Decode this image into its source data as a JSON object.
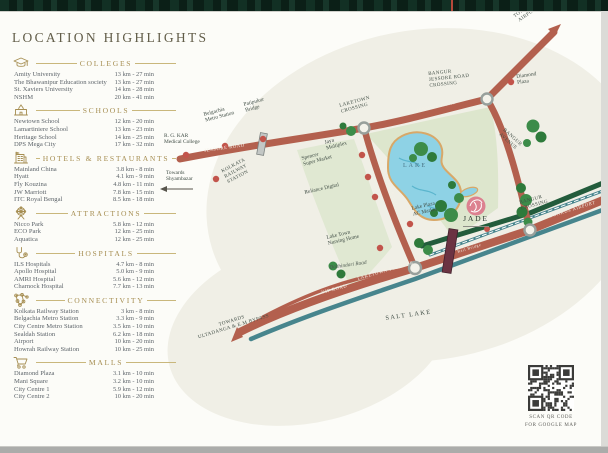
{
  "title": "LOCATION HIGHLIGHTS",
  "sidebar": {
    "sections": [
      {
        "id": "colleges",
        "label": "COLLEGES",
        "icon": "graduation-cap-icon",
        "items": [
          {
            "name": "Amity University",
            "value": "13 km - 27 min"
          },
          {
            "name": "The Bhawanipur Education society",
            "value": "13 km - 27 min"
          },
          {
            "name": "St. Xaviers University",
            "value": "14 km - 28 min"
          },
          {
            "name": "NSHM",
            "value": "20 km - 41 min"
          }
        ]
      },
      {
        "id": "schools",
        "label": "SCHOOLS",
        "icon": "school-icon",
        "items": [
          {
            "name": "Newtown School",
            "value": "12 km - 20 min"
          },
          {
            "name": "Lamartiniere School",
            "value": "13 km - 23 min"
          },
          {
            "name": "Heritage School",
            "value": "14 km - 25 min"
          },
          {
            "name": "DPS Mega City",
            "value": "17 km - 32 min"
          }
        ]
      },
      {
        "id": "hotels",
        "label": "HOTELS & RESTAURANTS",
        "icon": "hotel-icon",
        "items": [
          {
            "name": "Mainland China",
            "value": "3.8 km - 8 min"
          },
          {
            "name": "Hyatt",
            "value": "4.1 km - 9 min"
          },
          {
            "name": "Fly Kouzina",
            "value": "4.8 km - 11 min"
          },
          {
            "name": "JW Marriott",
            "value": "7.8 km - 15 min"
          },
          {
            "name": "ITC Royal Bengal",
            "value": "8.5 km - 18 min"
          }
        ]
      },
      {
        "id": "attractions",
        "label": "ATTRACTIONS",
        "icon": "ferris-wheel-icon",
        "items": [
          {
            "name": "Nicco Park",
            "value": "5.8 km - 12 min"
          },
          {
            "name": "ECO Park",
            "value": "12 km - 25 min"
          },
          {
            "name": "Aquatica",
            "value": "12 km - 25 min"
          }
        ]
      },
      {
        "id": "hospitals",
        "label": "HOSPITALS",
        "icon": "stethoscope-icon",
        "items": [
          {
            "name": "ILS Hospitals",
            "value": "4.7 km - 8 min"
          },
          {
            "name": "Apollo Hospital",
            "value": "5.0 km - 9 min"
          },
          {
            "name": "AMRI Hospital",
            "value": "5.6 km - 12 min"
          },
          {
            "name": "Charnock Hospital",
            "value": "7.7 km - 13 min"
          }
        ]
      },
      {
        "id": "connectivity",
        "label": "CONNECTIVITY",
        "icon": "network-icon",
        "items": [
          {
            "name": "Kolkata Railway Station",
            "value": "3 km - 8 min"
          },
          {
            "name": "Belgachia Metro Station",
            "value": "3.3 km - 9 min"
          },
          {
            "name": "City Centre Metro Station",
            "value": "3.5 km - 10 min"
          },
          {
            "name": "Sealdah Station",
            "value": "6.2 km - 18 min"
          },
          {
            "name": "Airport",
            "value": "10 km - 20 min"
          },
          {
            "name": "Howrah Railway Station",
            "value": "10 km - 25 min"
          }
        ]
      },
      {
        "id": "malls",
        "label": "MALLS",
        "icon": "cart-icon",
        "items": [
          {
            "name": "Diamond Plaza",
            "value": "3.1 km - 10 min"
          },
          {
            "name": "Mani Square",
            "value": "3.2 km - 10 min"
          },
          {
            "name": "City Centre 1",
            "value": "5.9 km - 12 min"
          },
          {
            "name": "City Centre 2",
            "value": "10 km - 20 min"
          }
        ]
      }
    ]
  },
  "map": {
    "labels": {
      "rgkar": "R. G. KAR\nMedical College",
      "towards_shyambazar": "Towards\nShyambazar",
      "belgachia": "Belgachia\nMetro Station",
      "patipukur": "Patipukur\nBridge",
      "kolkata_station": "KOLKATA\nRAILWAY\nSTATION",
      "laketown_crossing": "LAKETOWN\nCROSSING",
      "bangur_jessore_crossing": "BANGUR\nJESSORE ROAD\nCROSSING",
      "towards_airport_top": "TOWARDS\nAIRPORT",
      "diamond_plaza": "Diamond\nPlaza",
      "bangur_avenue": "BANGUR\nAVENUE",
      "jaya": "Jaya\nMultiplex",
      "spencer": "Spencer\nSuper Market",
      "reliance": "Reliance Digital",
      "nursing_home": "Lake Town\nNursing Home",
      "lake_plaza": "Lake Plaza\nAC Market",
      "bangur_crossing": "BANGUR\nCROSSING",
      "salt_lake": "SALT LAKE",
      "towards_bypass": "TOWARDS\nULTADANGA & E.M BYPASS",
      "dakhindari": "Dakhindari Road",
      "lake": "LAKE",
      "jade": "JADE"
    },
    "roads": {
      "jessore": "JESSORE ROAD",
      "vip": "VIP ROAD",
      "laketown_flyover": "LAKETOWN FLYOVER",
      "laketown_road": "LAKETOWN ROAD",
      "towards_airport": "TOWARDS AIRPORT",
      "rail_bridge": "Rail Bridge"
    },
    "qr_caption": "SCAN QR CODE\nFOR GOOGLE MAP"
  },
  "colors": {
    "gold": "#a68e52",
    "road_red": "#b3604e",
    "teal": "#47858d",
    "dark_green_road": "#235c3c",
    "lake_blue": "#8ed2e5",
    "marker_red": "#c2544b",
    "cream": "#f0efe6",
    "sage": "#dfe7d0"
  }
}
